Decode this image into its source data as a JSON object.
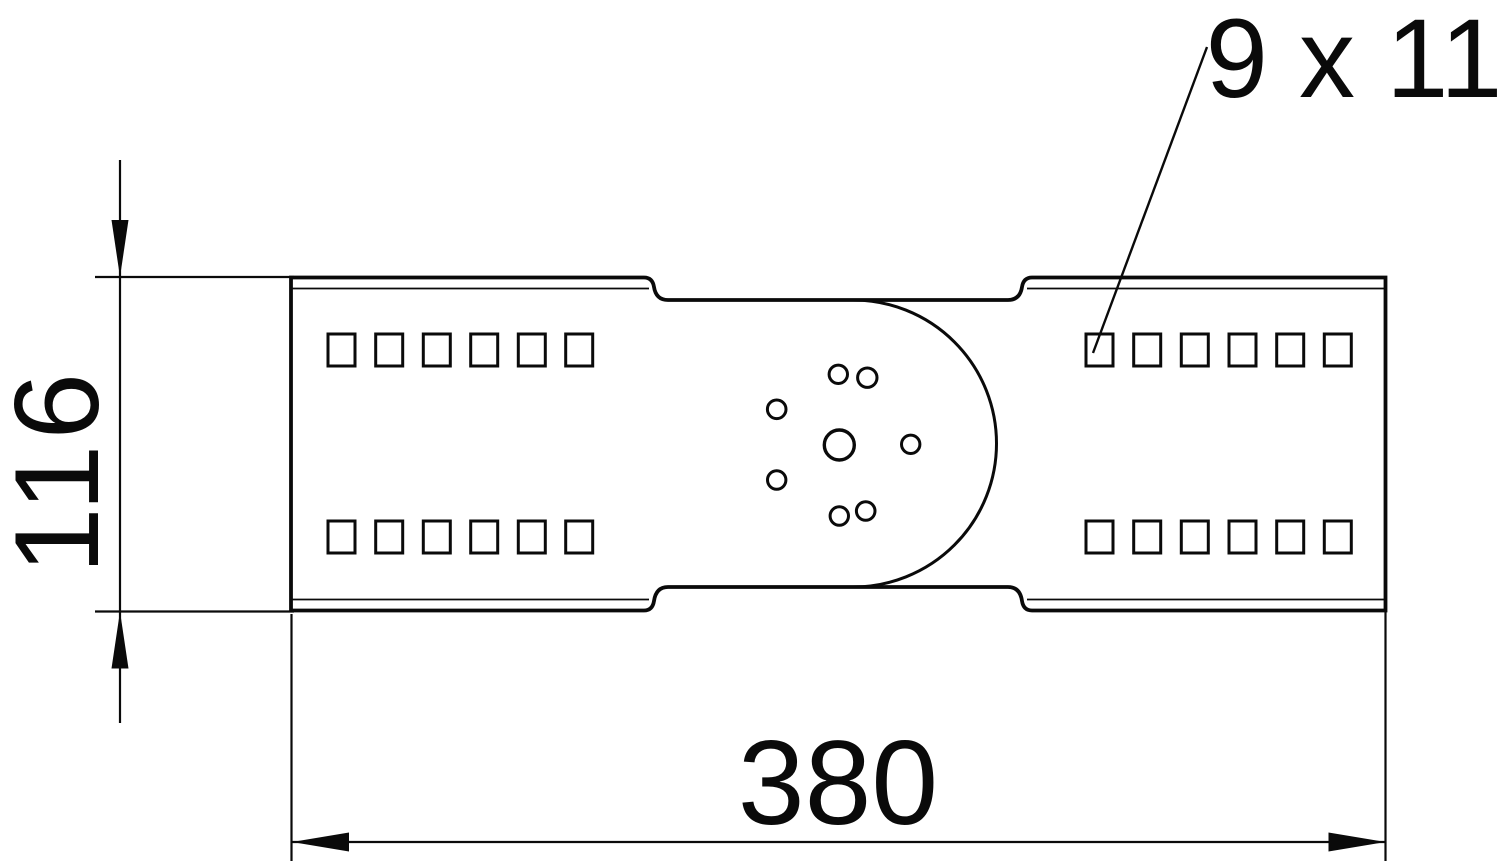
{
  "colors": {
    "ink": "#0a0a0a",
    "background": "#ffffff"
  },
  "part": {
    "outline_path": "M 291 277.5 L 644 277.5 Q 652.5 277.5 654 287 Q 656 300 668 300 L 1008 300 Q 1020 300 1022 287 Q 1023.5 277.5 1032 277.5 L 1385.5 277.5 L 1385.5 610.5 L 1032 610.5 Q 1023.5 610.5 1022 601 Q 1020 587 1008 587 L 668 587 Q 656 587 654 601 Q 652.5 610.5 644 610.5 L 291 610.5 Z",
    "inner_edges": [
      [
        291,
        288.5,
        649,
        288.5
      ],
      [
        1027,
        288.5,
        1385.5,
        288.5
      ],
      [
        291,
        599.5,
        649,
        599.5
      ],
      [
        1027,
        599.5,
        1385.5,
        599.5
      ]
    ],
    "hinge_arc": {
      "cx": 853,
      "cy": 443.5,
      "r": 143.5
    },
    "slots": {
      "w": 27,
      "h": 32,
      "rows_y": [
        334,
        521
      ],
      "left_x": [
        328,
        375.7,
        423.3,
        470.7,
        518.3,
        565.7
      ],
      "right_x": [
        1086,
        1133.7,
        1181.3,
        1229,
        1276.7,
        1324.3
      ]
    },
    "holes": {
      "center": {
        "cx": 839.3,
        "cy": 445,
        "r": 15
      },
      "small": [
        {
          "cx": 838.3,
          "cy": 374.3,
          "r": 9.2
        },
        {
          "cx": 867.3,
          "cy": 377.7,
          "r": 9.7
        },
        {
          "cx": 776.7,
          "cy": 409.3,
          "r": 9.3
        },
        {
          "cx": 910.7,
          "cy": 444.3,
          "r": 9.2
        },
        {
          "cx": 776.7,
          "cy": 480,
          "r": 9.2
        },
        {
          "cx": 839.3,
          "cy": 516,
          "r": 9.2
        },
        {
          "cx": 865.7,
          "cy": 511,
          "r": 9.3
        }
      ]
    }
  },
  "dimensions": {
    "height": {
      "label": "116",
      "lines": [
        [
          120,
          160,
          120,
          723
        ],
        [
          95,
          277,
          294,
          277
        ],
        [
          95,
          611.5,
          294,
          611.5
        ]
      ],
      "arrows": [
        "120,277 111.5,220 128.5,220",
        "120,611.5 111.5,668.5 128.5,668.5"
      ]
    },
    "width": {
      "label": "380",
      "lines": [
        [
          292,
          842,
          1385.5,
          842
        ],
        [
          291.5,
          614,
          291.5,
          861
        ],
        [
          1385.5,
          612,
          1385.5,
          861
        ]
      ],
      "arrows": [
        "292,842 349,832.5 349,851.5",
        "1385.5,842 1328.5,832.5 1328.5,851.5"
      ]
    },
    "slot_callout": {
      "label": "9 x 11",
      "leader": [
        1207,
        47,
        1093,
        353
      ]
    }
  }
}
